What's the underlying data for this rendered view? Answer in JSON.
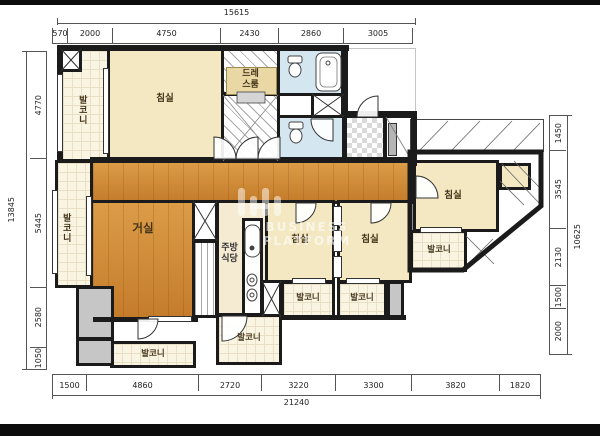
{
  "plan": {
    "watermark": "BUSINESS PLATFORM",
    "rooms": {
      "bedroom": "침실",
      "living": "거실",
      "kitchen_line1": "주방",
      "kitchen_line2": "식당",
      "dress_line1": "드레",
      "dress_line2": "스룸",
      "balcony": "발코니"
    },
    "colors": {
      "wood_floor": "#cf8a36",
      "bedroom_cream": "#f3e8c2",
      "balcony_cream": "#faf4e3",
      "bath_blue": "#d4e7f1",
      "utility_gray": "#c6c6c6",
      "wall_black": "#1b1b1b"
    }
  },
  "dimensions": {
    "top": {
      "total": "15615",
      "segments": [
        "570",
        "2000",
        "4750",
        "2430",
        "2860",
        "3005"
      ]
    },
    "bottom": {
      "total": "21240",
      "segments": [
        "1500",
        "4860",
        "2720",
        "3220",
        "3300",
        "3820",
        "1820"
      ]
    },
    "left": {
      "total": "13845",
      "segments": [
        "4770",
        "5445",
        "2580",
        "1050"
      ]
    },
    "right": {
      "total": "10625",
      "segments": [
        "1450",
        "3545",
        "2130",
        "1500",
        "2000"
      ]
    }
  }
}
